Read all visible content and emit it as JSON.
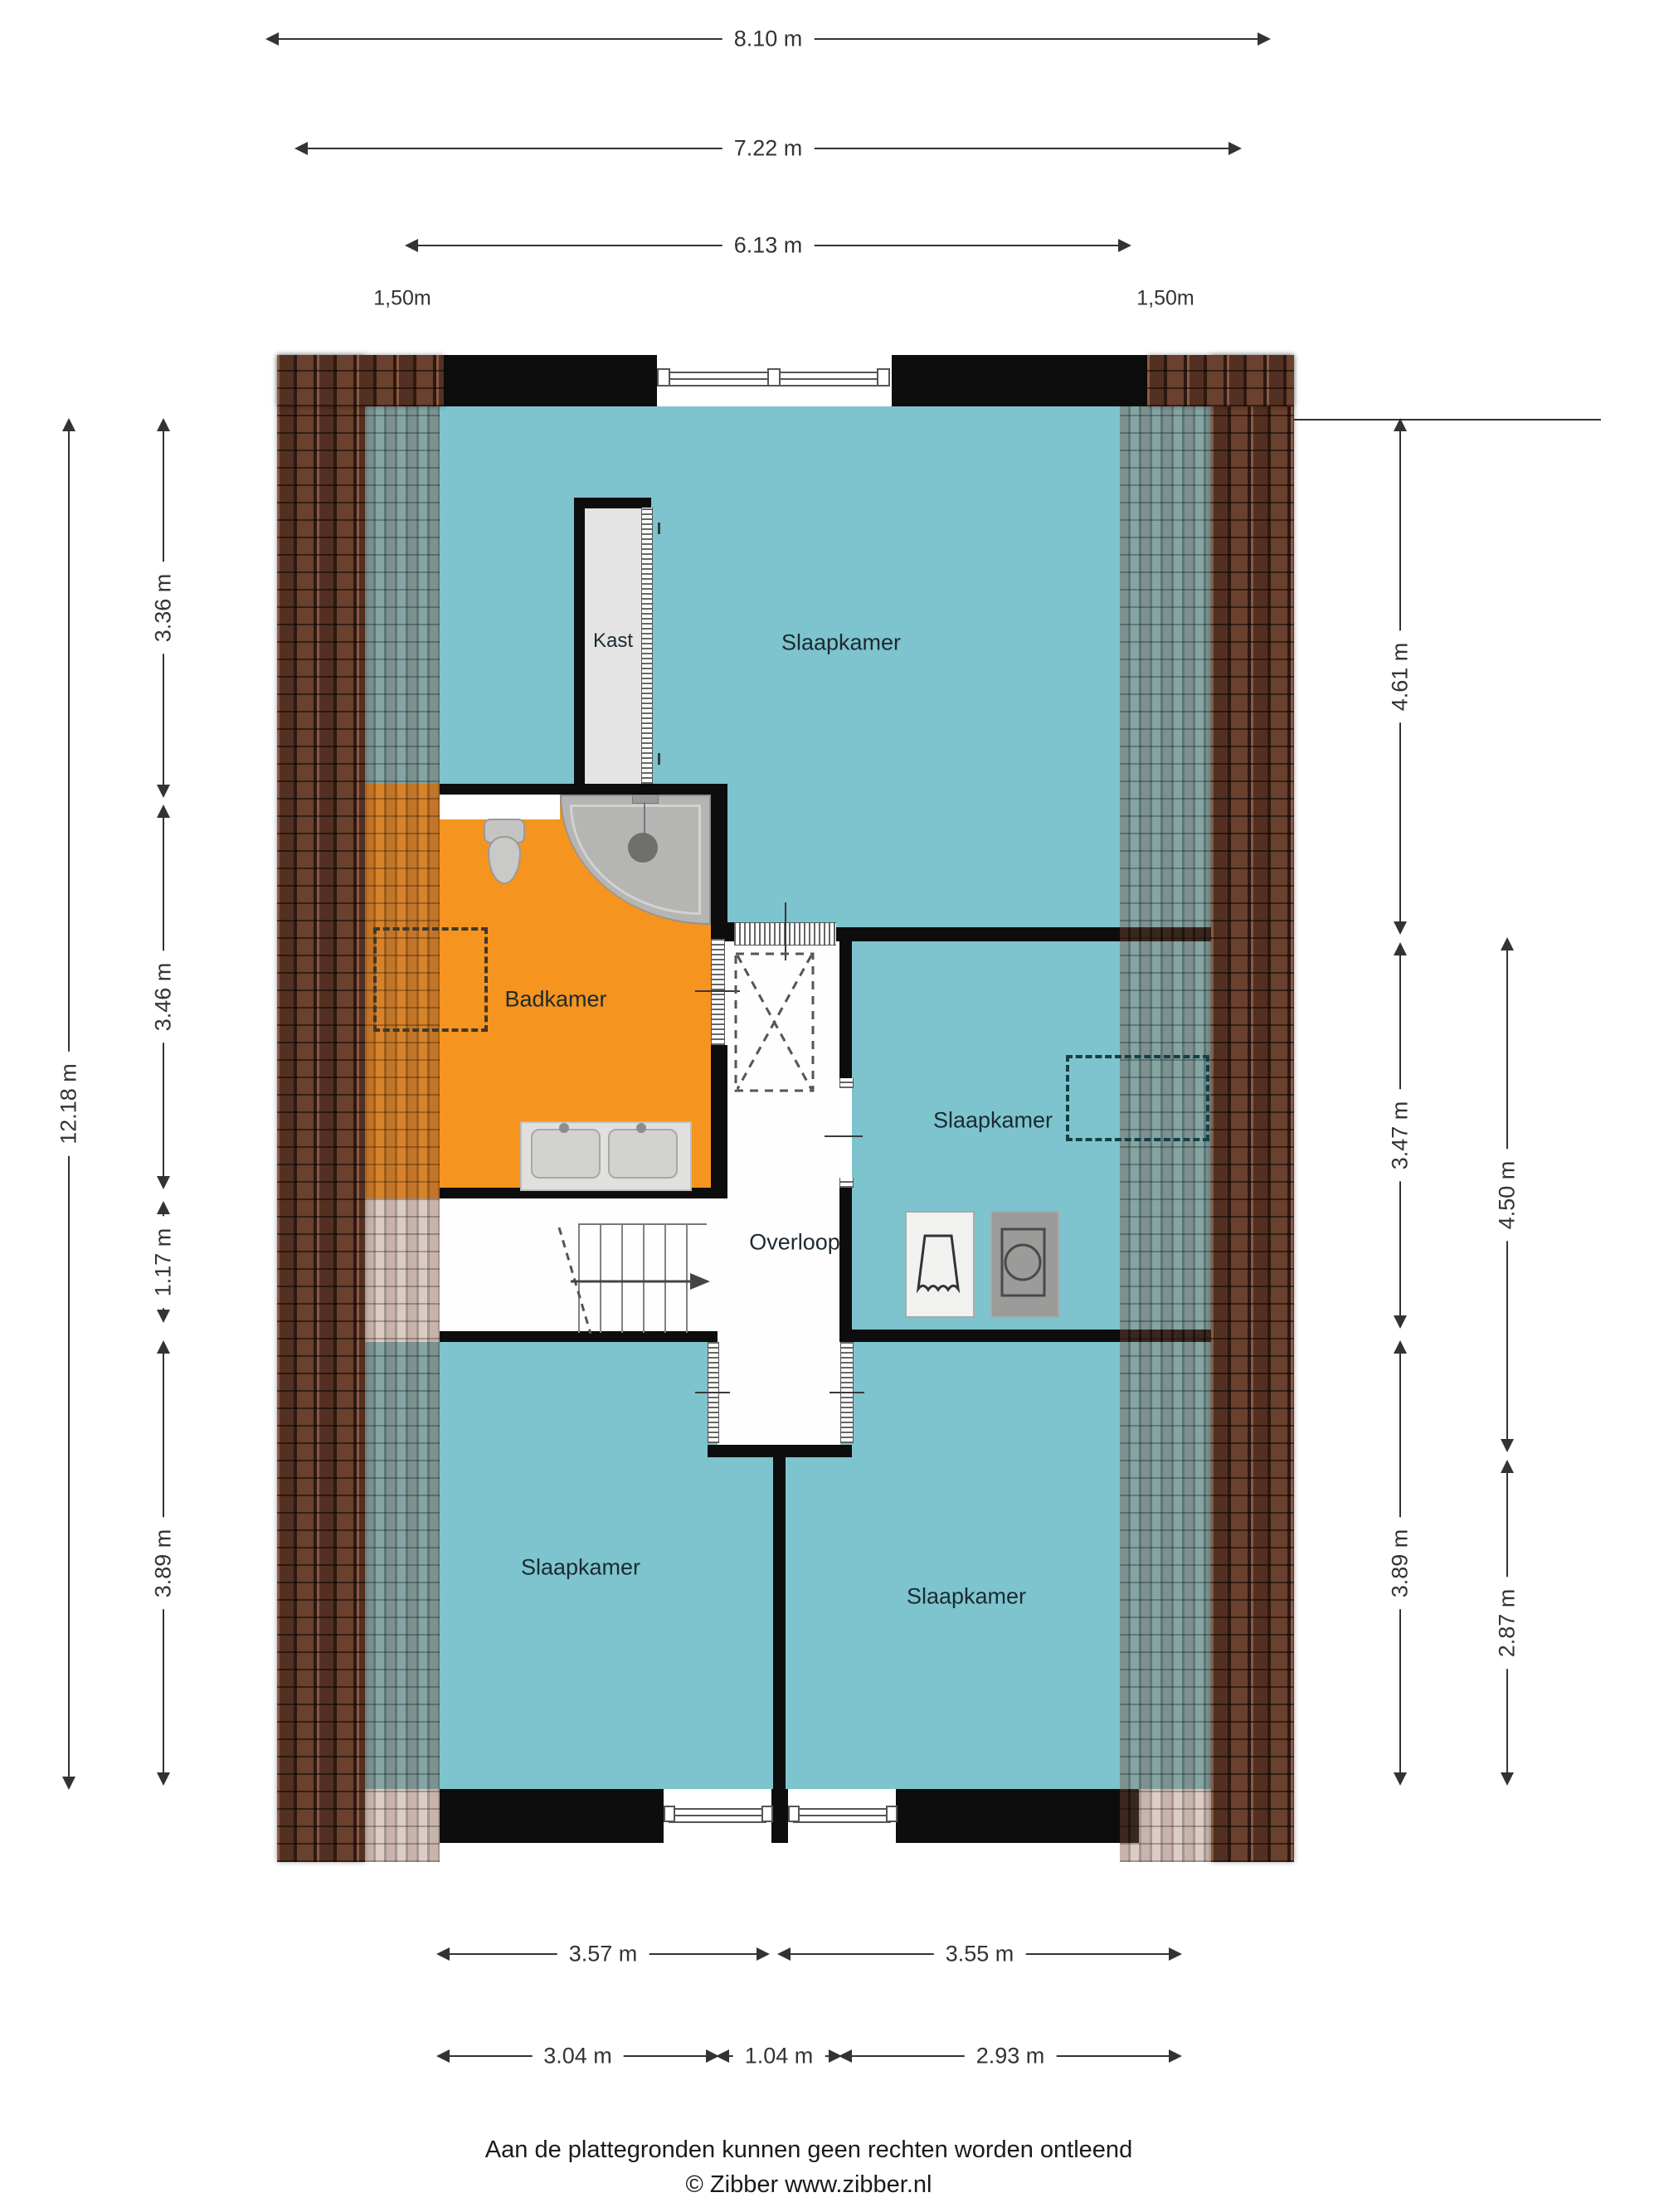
{
  "plan_title": "floor-plan-upper-storey",
  "colors": {
    "room_fill_teal": "#7dc4ce",
    "room_fill_orange": "#f5941f",
    "wall": "#0d0d0d",
    "roof_tile": "#4d2d1f",
    "closet_fill": "#e4e4e4"
  },
  "rooms": [
    {
      "id": "slaapkamer-top",
      "label": "Slaapkamer"
    },
    {
      "id": "kast",
      "label": "Kast"
    },
    {
      "id": "badkamer",
      "label": "Badkamer"
    },
    {
      "id": "overloop",
      "label": "Overloop"
    },
    {
      "id": "slaapkamer-right",
      "label": "Slaapkamer"
    },
    {
      "id": "slaapkamer-bottom-left",
      "label": "Slaapkamer"
    },
    {
      "id": "slaapkamer-bottom-right",
      "label": "Slaapkamer"
    }
  ],
  "dims": {
    "top": [
      "8.10 m",
      "7.22 m",
      "6.13 m"
    ],
    "eaves": [
      "1,50m",
      "1,50m"
    ],
    "left_outer": "12.18 m",
    "left": [
      "3.36 m",
      "3.46 m",
      "1.17 m",
      "3.89 m"
    ],
    "right": [
      "4.61 m",
      "3.47 m",
      "3.89 m"
    ],
    "right_outer": [
      "4.50 m",
      "2.87 m"
    ],
    "bottom_row1": [
      "3.57 m",
      "3.55 m"
    ],
    "bottom_row2": [
      "3.04 m",
      "1.04 m",
      "2.93 m"
    ]
  },
  "icons": {
    "shower": "shower-icon",
    "toilet": "toilet-icon",
    "double_sink": "double-sink-icon",
    "laundry": "laundry-basket-icon",
    "washing_machine": "washing-machine-icon",
    "stairs": "stairs-up-arrow-icon",
    "skylight": "skylight-dashed-icon"
  },
  "footer": {
    "disclaimer": "Aan de plattegronden kunnen geen rechten worden ontleend",
    "credit": "© Zibber www.zibber.nl"
  }
}
